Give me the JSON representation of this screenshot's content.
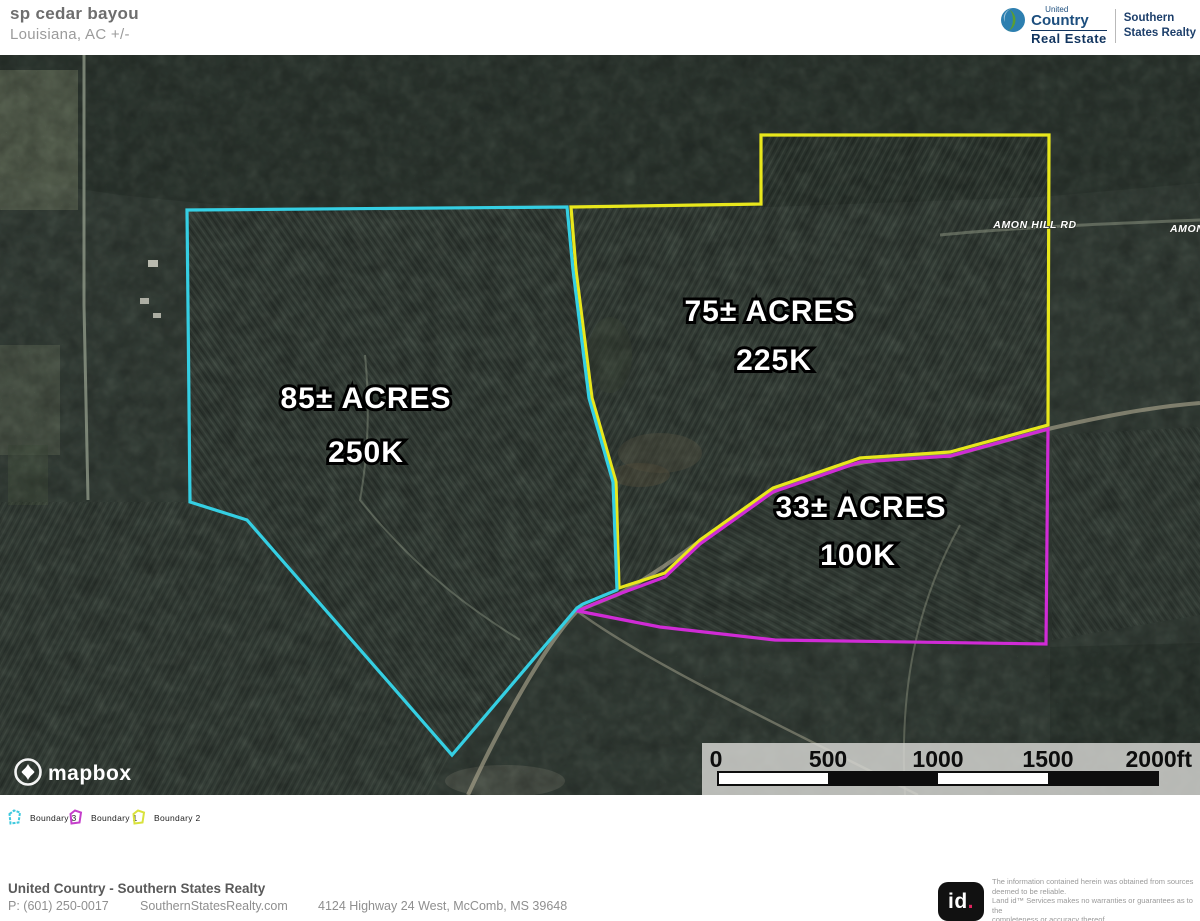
{
  "header": {
    "title": "sp cedar bayou",
    "subtitle": "Louisiana,  AC +/-",
    "brand": {
      "united": "United",
      "country": "Country",
      "real_estate": "Real Estate",
      "office_line1": "Southern",
      "office_line2": "States Realty"
    }
  },
  "map": {
    "labels": {
      "parcel85_acres": "85± ACRES",
      "parcel85_price": "250K",
      "parcel75_acres": "75± ACRES",
      "parcel75_price": "225K",
      "parcel33_acres": "33± ACRES",
      "parcel33_price": "100K"
    },
    "road_label": "AMON HILL RD",
    "road_label_right": "AMON HILL RD",
    "attribution": "mapbox",
    "scale_ticks": [
      "0",
      "500",
      "1000",
      "1500",
      "2000ft"
    ],
    "colors": {
      "boundary1_magenta": "#d02bd6",
      "boundary2_yellow": "#e8e71c",
      "boundary3_cyan": "#35cfe3"
    }
  },
  "legend": {
    "items": [
      {
        "label": "Boundary 3",
        "color": "#3ec9de"
      },
      {
        "label": "Boundary 1",
        "color": "#c53ecb"
      },
      {
        "label": "Boundary 2",
        "color": "#d9e23c"
      }
    ]
  },
  "footer": {
    "company": "United Country - Southern States Realty",
    "phone": "P: (601) 250-0017",
    "website": "SouthernStatesRealty.com",
    "address": "4124 Highway 24 West, McComb, MS 39648"
  },
  "land_id": {
    "logo_id": "id",
    "logo_dot": ".",
    "disclaimer": [
      "The information contained herein was obtained from sources",
      "deemed to be reliable.",
      "Land id™ Services makes no warranties or guarantees as to the",
      "completeness or accuracy thereof."
    ]
  }
}
